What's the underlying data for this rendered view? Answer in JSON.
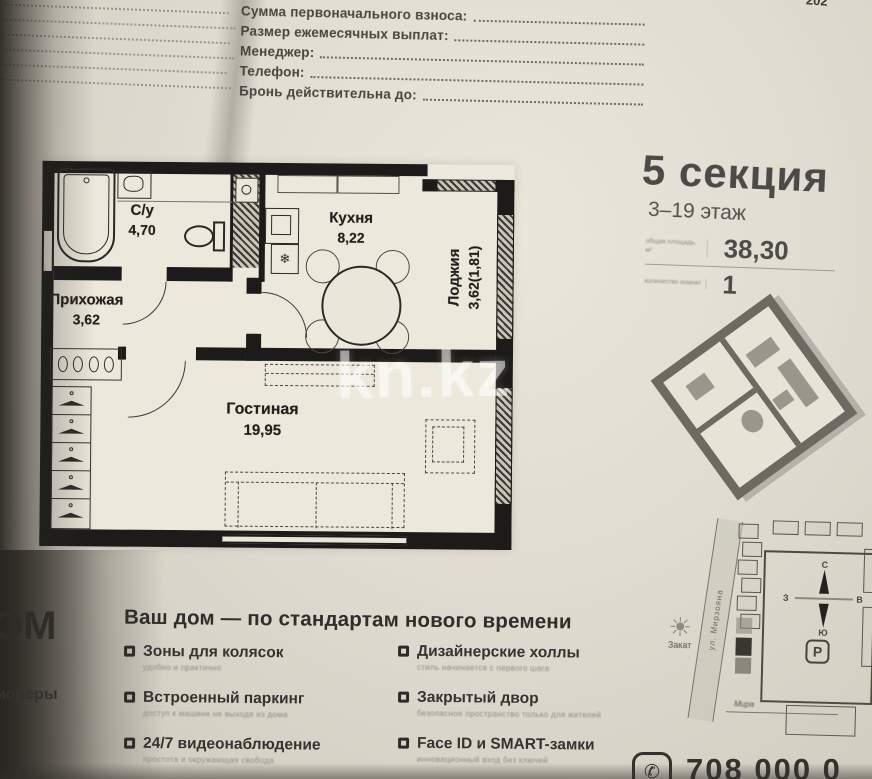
{
  "form": {
    "fields": [
      {
        "label": "Сумма первоначального взноса:"
      },
      {
        "label": "Размер ежемесячных выплат:"
      },
      {
        "label": "Менеджер:"
      },
      {
        "label": "Телефон:"
      },
      {
        "label": "Бронь действительна до:"
      }
    ]
  },
  "floor_plan": {
    "rooms": [
      {
        "name": "С/у",
        "area": "4,70"
      },
      {
        "name": "Кухня",
        "area": "8,22"
      },
      {
        "name": "Лоджия",
        "area": "3,62(1,81)"
      },
      {
        "name": "Прихожая",
        "area": "3,62"
      },
      {
        "name": "Гостиная",
        "area": "19,95"
      }
    ]
  },
  "info_panel": {
    "section_title": "5 секция",
    "floors": "3–19 этаж",
    "stats": [
      {
        "label": "общая площадь, м²",
        "value": "38,30"
      },
      {
        "label": "количество комнат",
        "value": "1"
      }
    ]
  },
  "site_plan": {
    "street": "ул. Мирзояна",
    "sunset_label": "Закат",
    "parking_label": "P",
    "note": "Мира",
    "compass": {
      "north": "С",
      "east": "В",
      "south": "Ю",
      "west": "З"
    }
  },
  "features": {
    "title": "Ваш дом — по стандартам нового времени",
    "items": [
      {
        "title": "Зоны для колясок",
        "subtitle": "удобно и практично"
      },
      {
        "title": "Встроенный паркинг",
        "subtitle": "доступ к машине не выходя из дома"
      },
      {
        "title": "24/7 видеонаблюдение",
        "subtitle": "простота и окружающая свобода"
      },
      {
        "title": "Дизайнерские холлы",
        "subtitle": "стиль начинается с первого шага"
      },
      {
        "title": "Закрытый двор",
        "subtitle": "безопасное пространство только для жителей"
      },
      {
        "title": "Face ID и SMART-замки",
        "subtitle": "инновационный вход без ключей"
      }
    ]
  },
  "watermark": {
    "text": "kn.kz"
  },
  "partials": {
    "corner": "202",
    "left_word_top": "ОМ",
    "left_word_bottom": "ионеры",
    "phone_digits": "708 000 0"
  }
}
